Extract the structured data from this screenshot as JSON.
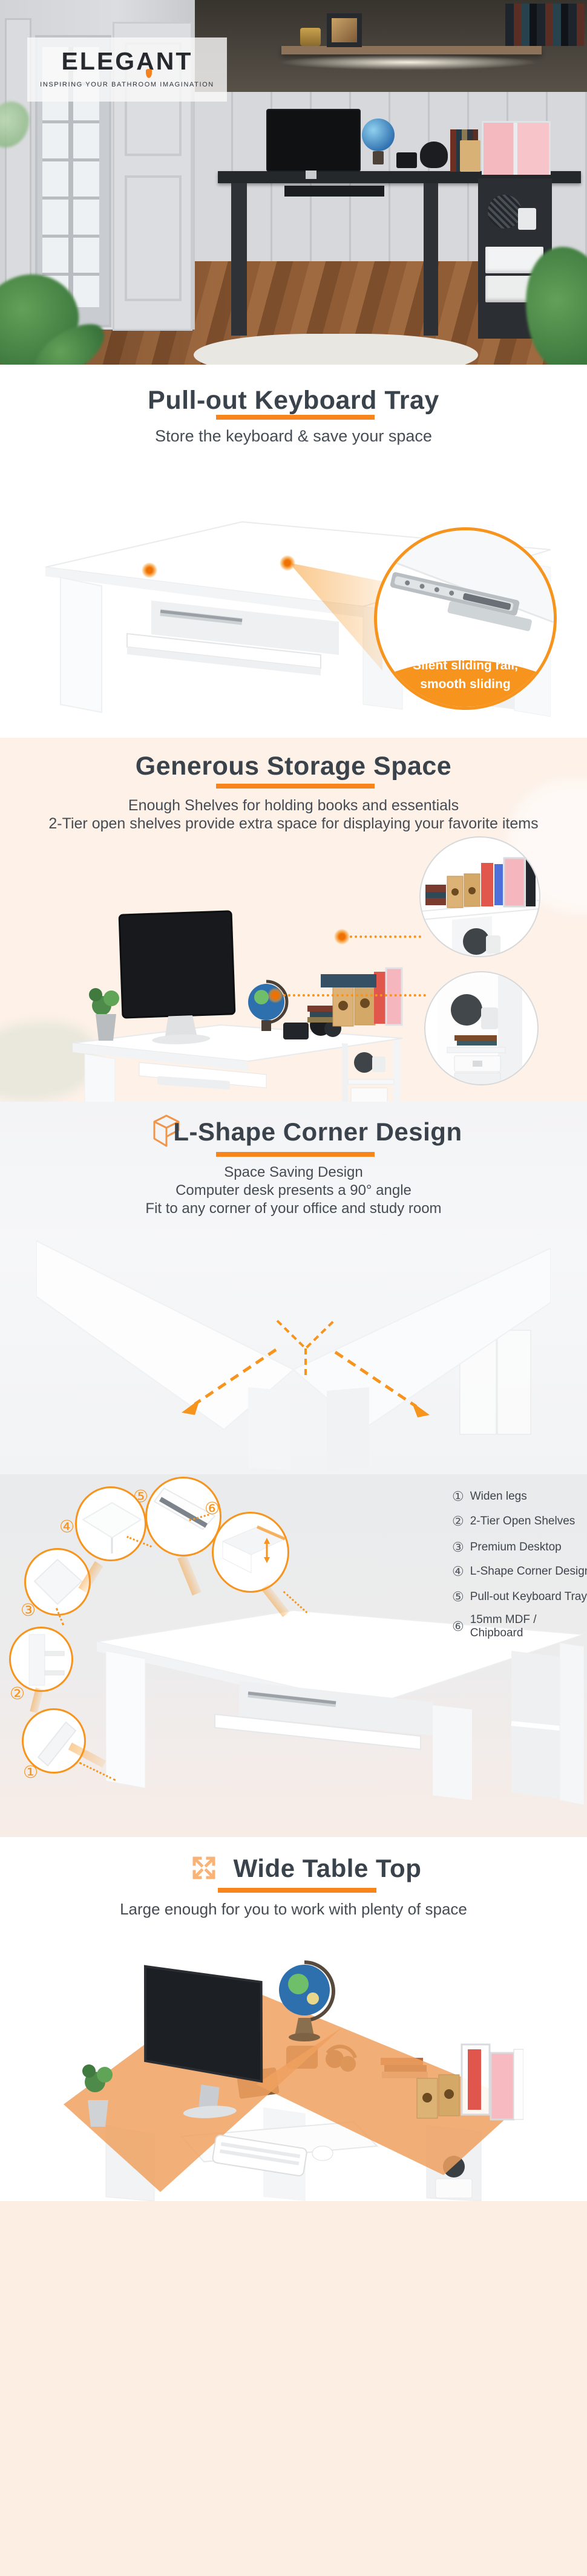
{
  "brand": {
    "name": "ELEGANT",
    "tagline": "INSPIRING YOUR BATHROOM IMAGINATION"
  },
  "colors": {
    "accent_orange": "#f8851b",
    "accent_circle": "#f6941e",
    "light_orange": "#f9b377",
    "title": "#3a424b",
    "body": "#464c54",
    "cream_bg": "#fdf1e8",
    "footer_bg": "#fdeee3",
    "gray_bg": "#f4f5f7"
  },
  "sections": {
    "keyboard_tray": {
      "title": "Pull-out Keyboard Tray",
      "subtitle": "Store the keyboard & save your space",
      "callout": {
        "line1": "Silent sliding rail,",
        "line2": "smooth sliding"
      }
    },
    "storage": {
      "title": "Generous Storage Space",
      "line1": "Enough Shelves for holding books and essentials",
      "line2": "2-Tier open shelves provide extra space for displaying your favorite items"
    },
    "corner": {
      "title": "L-Shape Corner Design",
      "line1": "Space Saving Design",
      "line2": "Computer desk presents a 90° angle",
      "line3": "Fit to any corner of your office and study room"
    },
    "features": {
      "list": [
        {
          "num": "①",
          "label": "Widen legs"
        },
        {
          "num": "②",
          "label": "2-Tier Open Shelves"
        },
        {
          "num": "③",
          "label": "Premium Desktop"
        },
        {
          "num": "④",
          "label": "L-Shape Corner Design"
        },
        {
          "num": "⑤",
          "label": "Pull-out Keyboard Tray"
        },
        {
          "num": "⑥",
          "label": "15mm MDF / Chipboard"
        }
      ]
    },
    "wide_top": {
      "title": "Wide Table Top",
      "subtitle": "Large enough for you to work with plenty of space"
    }
  }
}
